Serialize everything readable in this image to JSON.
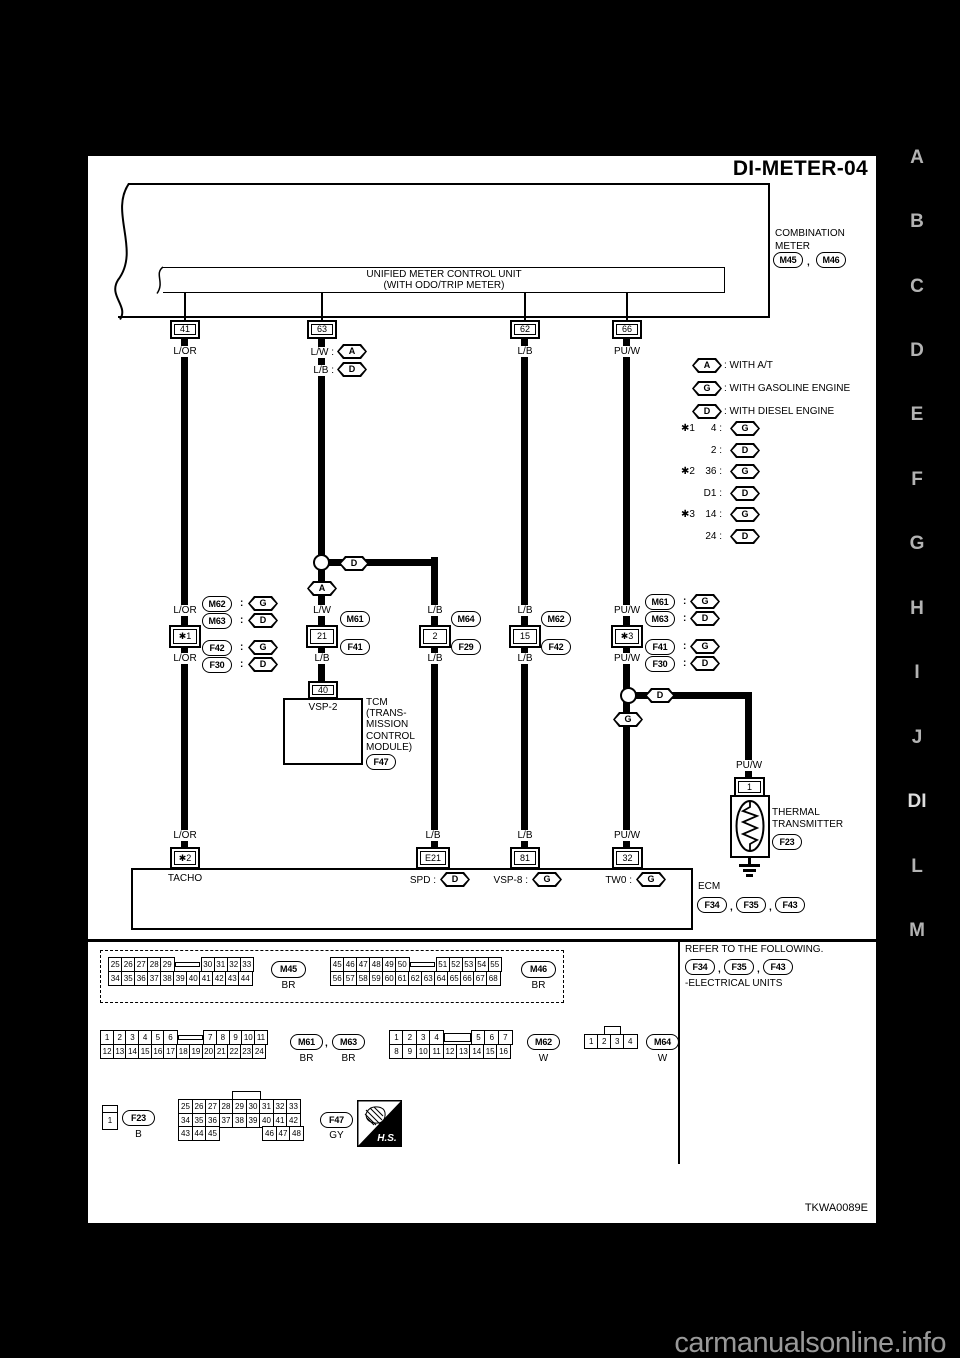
{
  "page": {
    "title": "DI-METER-04",
    "code": "TKWA0089E",
    "watermark": "carmanualsonline.info"
  },
  "punct": {
    "comma": ",",
    "colon": ":"
  },
  "nav": {
    "items": [
      "A",
      "B",
      "C",
      "D",
      "E",
      "F",
      "G",
      "H",
      "I",
      "J",
      "DI",
      "L",
      "M"
    ],
    "current": "DI"
  },
  "meter": {
    "name1": "COMBINATION",
    "name2": "METER",
    "ref1": "M45",
    "ref2": "M46",
    "unit1": "UNIFIED METER CONTROL UNIT",
    "unit2": "(WITH ODO/TRIP METER)"
  },
  "top": {
    "t41": {
      "pin": "41",
      "wire": "L/OR"
    },
    "t63": {
      "pin": "63",
      "w1": "L/W :",
      "tag1": "A",
      "w2": "L/B :",
      "tag2": "D"
    },
    "t62": {
      "pin": "62",
      "wire": "L/B"
    },
    "t66": {
      "pin": "66",
      "wire": "PU/W"
    }
  },
  "legend": {
    "a": {
      "tag": "A",
      "text": ": WITH A/T"
    },
    "g": {
      "tag": "G",
      "text": ": WITH GASOLINE ENGINE"
    },
    "d": {
      "tag": "D",
      "text": ": WITH DIESEL ENGINE"
    },
    "stars": [
      {
        "star": "✱1",
        "val": "4 :",
        "tag": "G"
      },
      {
        "star": "",
        "val": "2 :",
        "tag": "D"
      },
      {
        "star": "✱2",
        "val": "36 :",
        "tag": "G"
      },
      {
        "star": "",
        "val": "D1 :",
        "tag": "D"
      },
      {
        "star": "✱3",
        "val": "14 :",
        "tag": "G"
      },
      {
        "star": "",
        "val": "24 :",
        "tag": "D"
      }
    ]
  },
  "mid": {
    "col1": {
      "above": "L/OR",
      "pin": "✱1",
      "below": "L/OR",
      "r1": "M62",
      "t1": "G",
      "r2": "M63",
      "t2": "D",
      "r3": "F42",
      "t3": "G",
      "r4": "F30",
      "t4": "D"
    },
    "col2": {
      "above": "L/W",
      "pin": "21",
      "below": "L/B",
      "r1": "M61",
      "r2": "F41"
    },
    "col3": {
      "above": "L/B",
      "pin": "2",
      "below": "L/B",
      "r1": "M64",
      "r2": "F29"
    },
    "col4": {
      "above": "L/B",
      "pin": "15",
      "below": "L/B",
      "r1": "M62",
      "r2": "F42"
    },
    "col5": {
      "above": "PU/W",
      "pin": "✱3",
      "below": "PU/W",
      "r1": "M61",
      "t1": "G",
      "r2": "M63",
      "t2": "D",
      "r3": "F41",
      "t3": "G",
      "r4": "F30",
      "t4": "D"
    },
    "j2": {
      "tag": "D",
      "down": "A"
    },
    "j5": {
      "tag": "D",
      "down": "G"
    }
  },
  "tcm": {
    "pin": "40",
    "pin_name": "VSP-2",
    "l1": "TCM",
    "l2": "(TRANS-",
    "l3": "MISSION",
    "l4": "CONTROL",
    "l5": "MODULE)",
    "ref": "F47"
  },
  "thermal": {
    "wire": "PU/W",
    "pin": "1",
    "l1": "THERMAL",
    "l2": "TRANSMITTER",
    "ref": "F23"
  },
  "ecm": {
    "name": "ECM",
    "ref1": "F34",
    "ref2": "F35",
    "ref3": "F43",
    "t1": {
      "wire": "L/OR",
      "pin": "✱2",
      "label": "TACHO"
    },
    "t2": {
      "wire": "L/B",
      "pin": "E21",
      "label": "SPD :",
      "tag": "D"
    },
    "t3": {
      "wire": "L/B",
      "pin": "81",
      "label": "VSP-8 :",
      "tag": "G"
    },
    "t4": {
      "wire": "PU/W",
      "pin": "32",
      "label": "TW0 :",
      "tag": "G"
    }
  },
  "footer": {
    "refer": "REFER TO THE FOLLOWING.",
    "ref1": "F34",
    "ref2": "F35",
    "ref3": "F43",
    "note": "-ELECTRICAL UNITS",
    "hs": "H.S."
  },
  "pinouts": {
    "m45": {
      "label": "M45",
      "color": "BR",
      "row1": [
        "25",
        "26",
        "27",
        "28",
        "29",
        "KEY",
        "30",
        "31",
        "32",
        "33"
      ],
      "row2": [
        "34",
        "35",
        "36",
        "37",
        "38",
        "39",
        "40",
        "41",
        "42",
        "43",
        "44"
      ]
    },
    "m46": {
      "label": "M46",
      "color": "BR",
      "row1": [
        "45",
        "46",
        "47",
        "48",
        "49",
        "50",
        "KEY",
        "51",
        "52",
        "53",
        "54",
        "55"
      ],
      "row2": [
        "56",
        "57",
        "58",
        "59",
        "60",
        "61",
        "62",
        "63",
        "64",
        "65",
        "66",
        "67",
        "68"
      ]
    },
    "m61": {
      "label": "M61",
      "label2": "M63",
      "color": "BR",
      "color2": "BR",
      "row1": [
        "1",
        "2",
        "3",
        "4",
        "5",
        "6",
        "KEY",
        "7",
        "8",
        "9",
        "10",
        "11"
      ],
      "row2": [
        "12",
        "13",
        "14",
        "15",
        "16",
        "17",
        "18",
        "19",
        "20",
        "21",
        "22",
        "23",
        "24"
      ]
    },
    "m62": {
      "label": "M62",
      "color": "W",
      "row1": [
        "1",
        "2",
        "3",
        "4",
        "KEY2",
        "5",
        "6",
        "7"
      ],
      "row2": [
        "8",
        "9",
        "10",
        "11",
        "12",
        "13",
        "14",
        "15",
        "16"
      ]
    },
    "m64": {
      "label": "M64",
      "color": "W",
      "row1": [
        "1",
        "2",
        "3",
        "4"
      ]
    },
    "f23": {
      "label": "F23",
      "color": "B",
      "pin": "1"
    },
    "f47": {
      "label": "F47",
      "color": "GY",
      "row1": [
        "25",
        "26",
        "27",
        "28",
        "29",
        "30",
        "31",
        "32",
        "33"
      ],
      "row2": [
        "34",
        "35",
        "36",
        "37",
        "38",
        "39",
        "40",
        "41",
        "42"
      ],
      "row3": [
        "43",
        "44",
        "45",
        "GAP",
        "46",
        "47",
        "48"
      ]
    }
  }
}
